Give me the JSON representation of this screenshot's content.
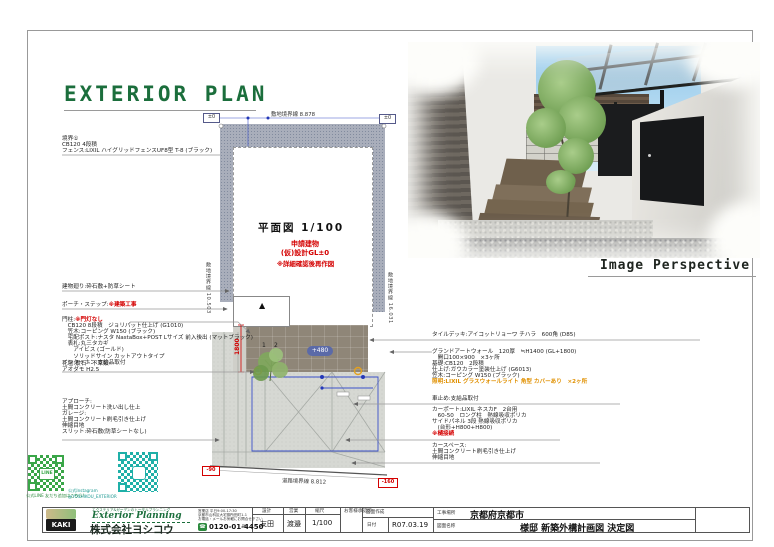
{
  "title": {
    "text": "EXTERIOR PLAN"
  },
  "perspective": {
    "caption": "Image Perspective"
  },
  "plan": {
    "caption": "平面図  1/100",
    "red1": "申請建物",
    "red2": "(仮)設計GL±0",
    "red3": "※詳細確認後再作図",
    "dim_top": "敷地境界線 8.878",
    "dim_left": "敷地境界線 10.503",
    "dim_right": "敷地境界線 16.031",
    "dim_road": "道路境界線 8.812",
    "deck_dim": "1800",
    "deck_level": "+480",
    "lv_tl": "±0",
    "lv_tr": "±0",
    "lv_bl": "-90",
    "lv_br": "-160",
    "marker1": "1",
    "marker2": "2",
    "porch_mark": "▲"
  },
  "left_notes": {
    "boundary": [
      "境界①",
      "CB120 4段積",
      "フェンス:LIXIL ハイグリッドフェンスUF8型 T-8 (ブラック)"
    ],
    "building": "建物廻り:砕石敷+防草シート",
    "porch_label": "ポーチ・ステップ:",
    "porch_red": "※建築工事",
    "gate_label": "門柱:",
    "gate_red": "※門灯なし",
    "gate_lines": [
      "　CB120 8段積　ジョリパット仕上げ (G1010)",
      "　笠木:コーピング W150 (ブラック)",
      "　宅配ポスト:ナスタ NastaBox+POST Lサイズ 前入後出 (マットブラック)",
      "　表札:丸三タカギ",
      "　　アイビス (ゴールド)",
      "　　ソリッドサイン カットアウトタイプ",
      "インターホン:支給品取付"
    ],
    "flower": [
      "花壇:景石・下草類",
      "アオダモ H2.5"
    ],
    "approach": [
      "アプローチ:",
      "土間コンクリート洗い出し仕上",
      "ガレージ:",
      "土間コンクリート刷毛引き仕上げ",
      "伸縮目地",
      "スリット:砕石敷(防草シートなし)"
    ]
  },
  "right_notes": {
    "deck": "タイルデッキ:アイコットリョーワ チハラ　600角 (D85)",
    "wall_lines": [
      "グランドアートウォール　120厚　≒H1400 (GL+1800)",
      "　開口100×900　×3ヶ所",
      "基礎:CB120　2段積",
      "仕上げ:ガウカラー塗装仕上げ (G6013)",
      "笠木:コーピング W150 (ブラック)"
    ],
    "wall_light": "照明:LIXIL グラスウォールライト 角型 カバーあり　×2ヶ所",
    "stopper": "車止め:支給品取付",
    "carport_lines": [
      "カーポート:LIXIL ネスカF　2台用",
      "　60-50　ロング柱　熱線吸収ポリカ",
      "サイドパネル 3段 熱線吸収ポリカ",
      "　(台形+H800+H800)"
    ],
    "carport_red": "※樋接続",
    "carspace": [
      "カースペース:",
      "土間コンクリート刷毛引き仕上げ",
      "伸縮目地"
    ]
  },
  "qr": {
    "line_caption": "公式LINE 友だち追加はこちら!",
    "insta_caption1": "公式Instagram",
    "insta_caption2": "@YOSHIKOU_EXTERIOR",
    "line_logo": "LINE"
  },
  "titleblock": {
    "brand_tagline": "エクステリア&ガーデンのトータルプランニング",
    "brand_en": "Exterior Planning",
    "company": "株式会社ヨシコウ",
    "logo_text": "KAKI",
    "info1": "営業店 平日9:00-17:30",
    "info2": "京都市山科区大宅御所田町1-1",
    "info3": "お電話・メールお気軽にお問合せ下さい",
    "phone": "0120-01-4450",
    "phone_icon": "☎",
    "mail_icon": "✉",
    "col_design_label": "設計",
    "col_design_value": "友田",
    "col_sales_label": "営業",
    "col_sales_value": "渡邉",
    "col_scale_label": "縮尺",
    "col_scale_value": "1/100",
    "col_approval_label": "お客様承認印",
    "col_created_label": "図面作成",
    "col_date_label": "日付",
    "col_date_value": "R07.03.19",
    "site_label": "工事場所",
    "site_value": "京都府京都市",
    "drawing_label": "図面名称",
    "drawing_value": "様邸 新築外構計画図 決定図"
  },
  "colors": {
    "brand_green": "#1b6e3c",
    "alert_red": "#d40000",
    "light_orange": "#e09000",
    "dim_blue": "#3a50c8"
  }
}
